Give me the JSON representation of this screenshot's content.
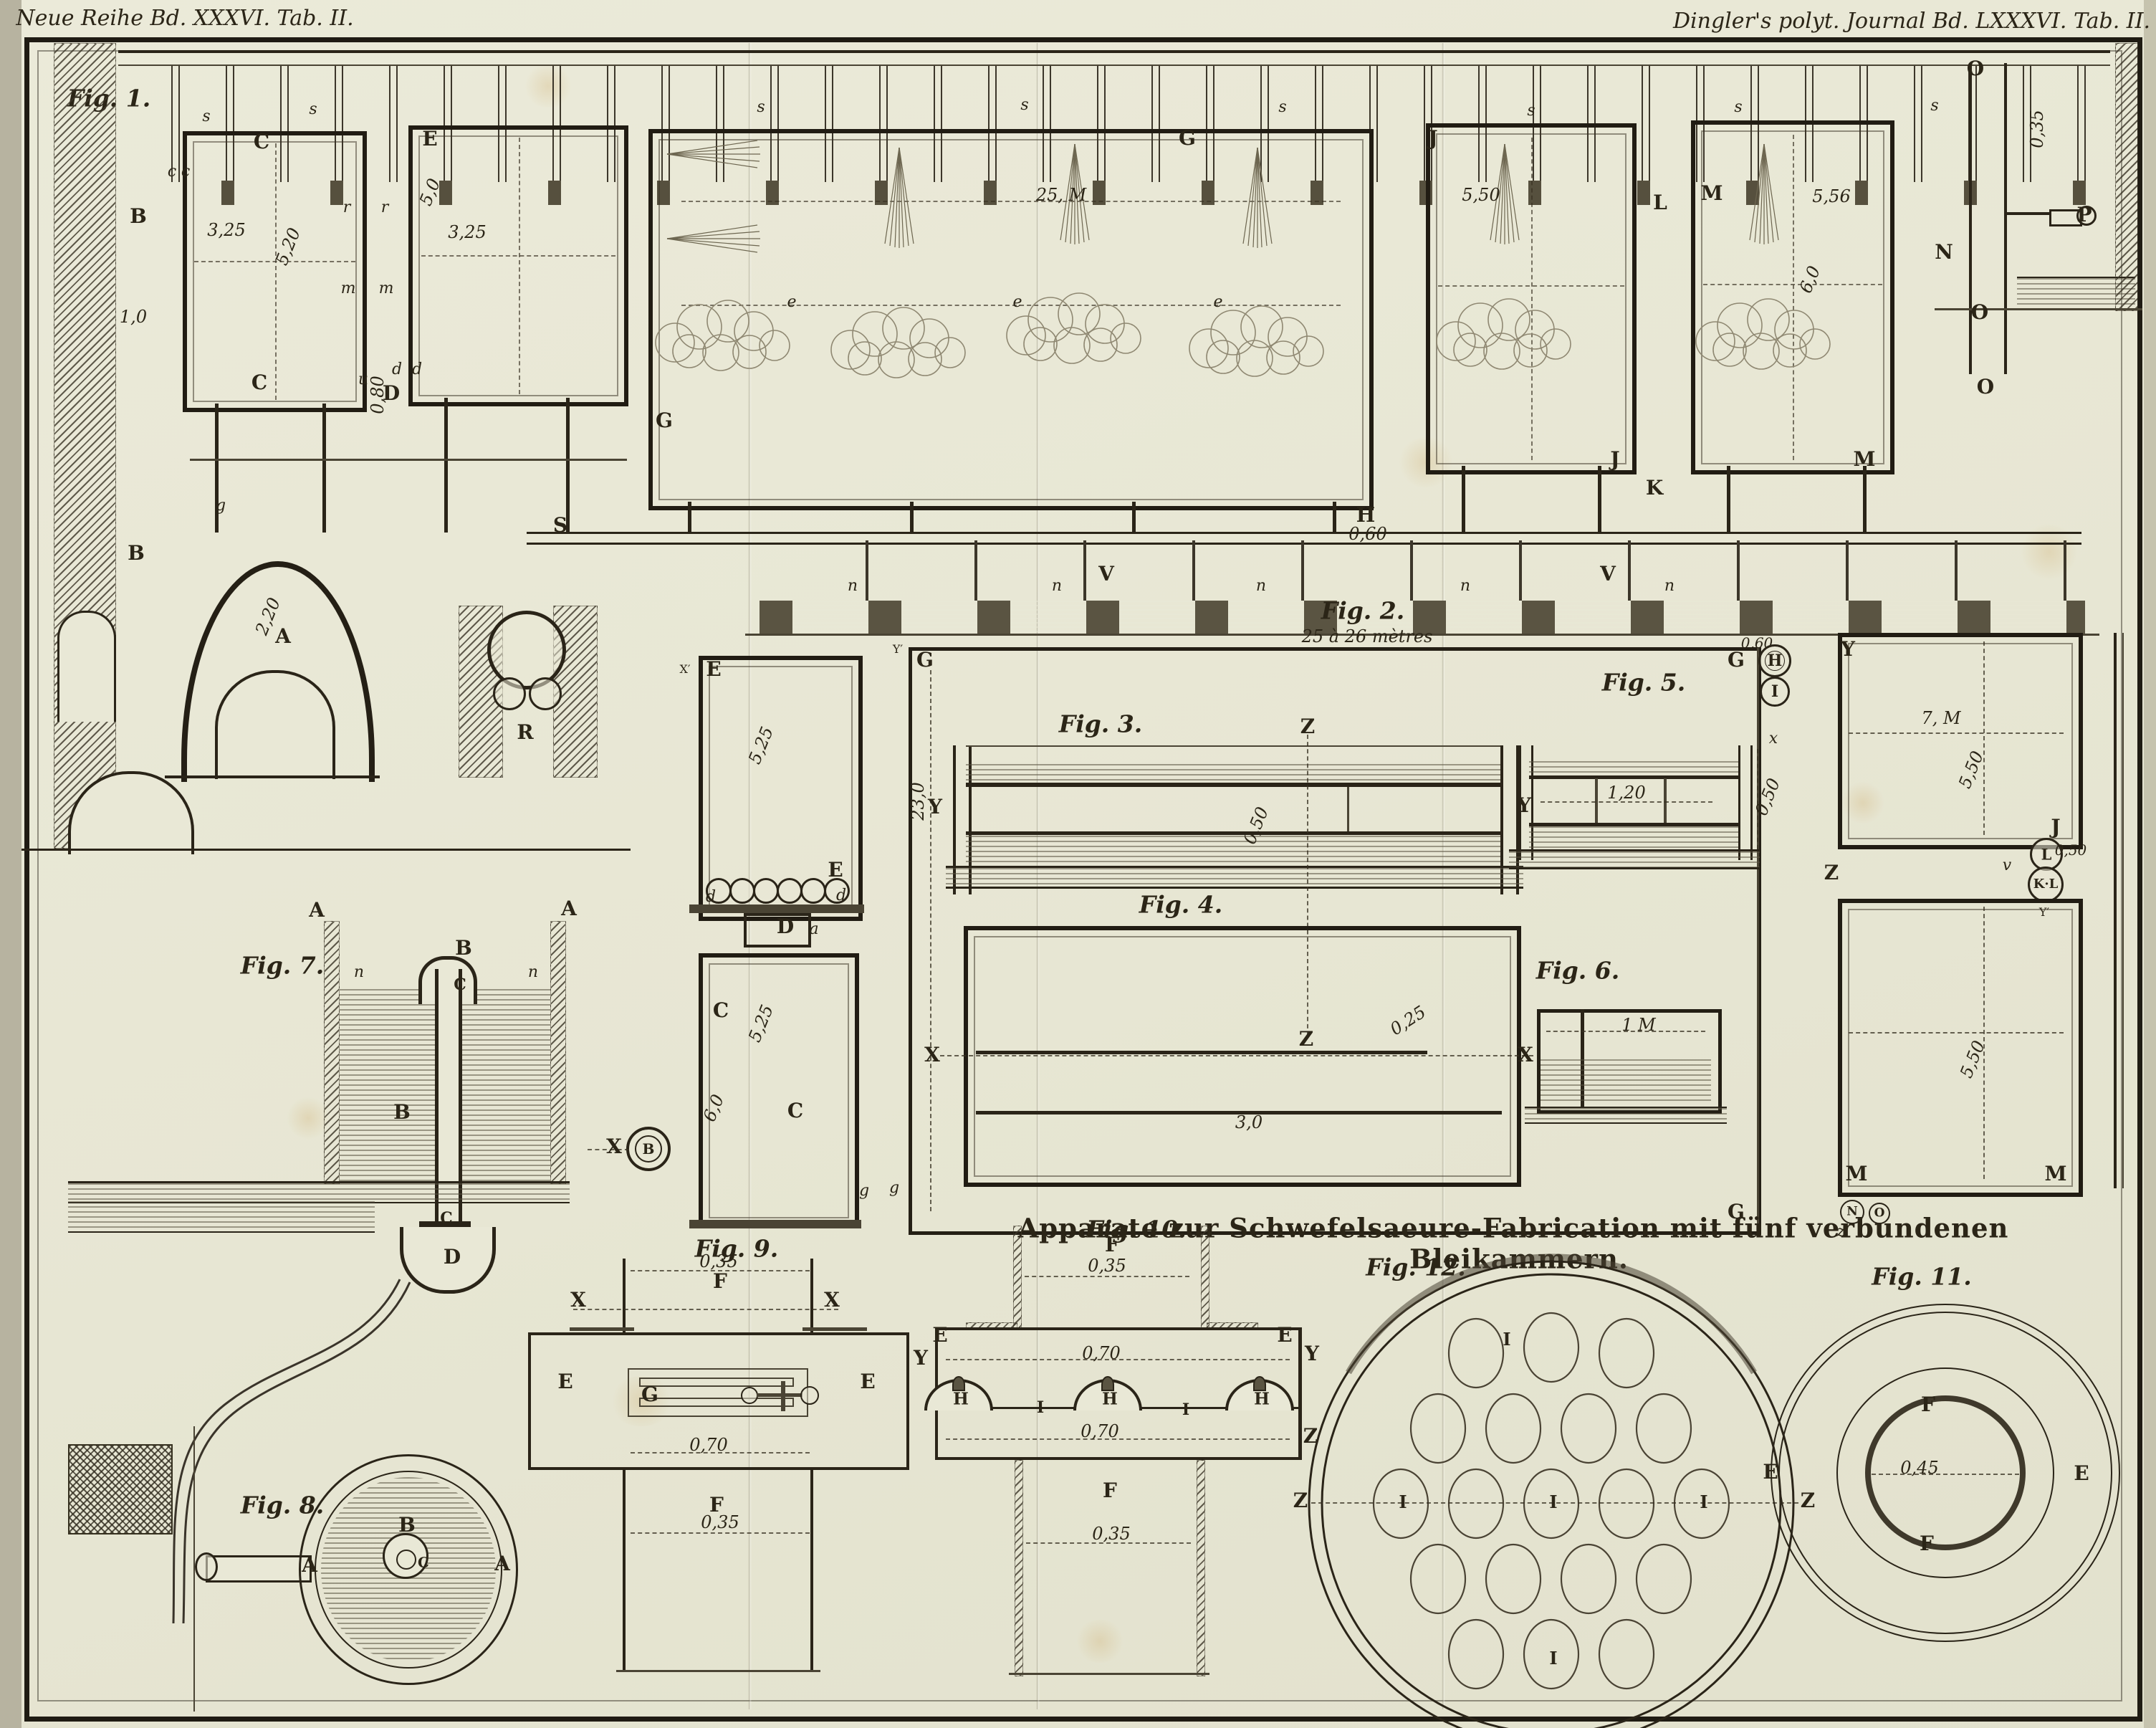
{
  "header": {
    "left": "Neue Reihe Bd. XXXVI. Tab. II.",
    "right": "Dingler's polyt. Journal Bd. LXXXVI. Tab. II."
  },
  "title": {
    "line1": "Apparate zur Schwefelsaeure-Fabrication mit fünf verbundenen",
    "line2": "Bleikammern."
  },
  "figures": {
    "fig1": "Fig. 1.",
    "fig2": "Fig. 2.",
    "fig3": "Fig. 3.",
    "fig4": "Fig. 4.",
    "fig5": "Fig. 5.",
    "fig6": "Fig. 6.",
    "fig7": "Fig. 7.",
    "fig8": "Fig. 8.",
    "fig9": "Fig. 9.",
    "fig10": "Fig. 10.",
    "fig11": "Fig. 11.",
    "fig12": "Fig. 12."
  },
  "dims": {
    "span": "25 à 26 mètres",
    "w3_25": "3,25",
    "h5_20": "5,20",
    "h5_0": "5,0",
    "g0_80": "0,80",
    "len25": "25, M",
    "w5_50": "5,50",
    "w5_56": "5,56",
    "h6_0": "6,0",
    "h1_0": "1,0",
    "h2_20": "2,20",
    "v0_35": "0,35",
    "v0_60": "0,60",
    "v0_50": "0,50",
    "w0_70": "0,70",
    "w1_20": "1,20",
    "w1M": "1 M",
    "w0_45": "0,45",
    "w3_0": "3,0",
    "d0_25": "0,25",
    "h23_0": "23,0",
    "w7M": "7, M",
    "h5_25": "5,25"
  },
  "glyphs": {
    "A": "A",
    "B": "B",
    "C": "C",
    "D": "D",
    "E": "E",
    "F": "F",
    "G": "G",
    "H": "H",
    "I": "I",
    "J": "J",
    "K": "K",
    "L": "L",
    "M": "M",
    "N": "N",
    "O": "O",
    "P": "P",
    "R": "R",
    "S": "S",
    "V": "V",
    "X": "X",
    "Y": "Y",
    "Z": "Z",
    "KL": "K·L",
    "Yp": "Y′",
    "Xp": "X′",
    "a": "a",
    "c": "c",
    "d": "d",
    "e": "e",
    "g": "g",
    "m": "m",
    "n": "n",
    "o": "o",
    "r": "r",
    "s": "s",
    "u": "u",
    "v": "v",
    "x": "x",
    "y": "y",
    "z": "z"
  }
}
